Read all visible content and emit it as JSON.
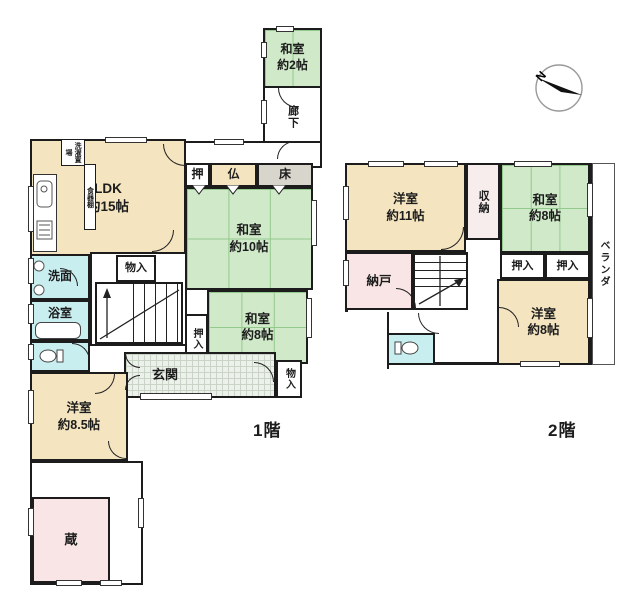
{
  "colors": {
    "wall": "#1c1c1c",
    "tatami": "#cfe9c9",
    "tatami_line": "#94c98e",
    "wood": "#f4e5c0",
    "wet": "#c9eef0",
    "pink": "#f9e5e5",
    "pale_pink": "#f7eded",
    "tokonoma": "#d7d5cc",
    "genkan": "#edf1eb",
    "genkan_line": "#c9d3c6"
  },
  "compass": {
    "label": "N"
  },
  "floors": {
    "f1": {
      "label": "1階",
      "rooms": {
        "washitsu2": {
          "name": "和室",
          "size": "約2帖"
        },
        "rouka": {
          "name": "廊下"
        },
        "ldk": {
          "name": "LDK",
          "size": "約15帖"
        },
        "sentaku": {
          "name": "洗濯置場"
        },
        "shokkidana": {
          "name": "食器棚"
        },
        "oshi": {
          "name": "押"
        },
        "butsu": {
          "name": "仏"
        },
        "toko": {
          "name": "床"
        },
        "washitsu10": {
          "name": "和室",
          "size": "約10帖"
        },
        "washitsu8": {
          "name": "和室",
          "size": "約8帖"
        },
        "oshiire": {
          "name": "押入"
        },
        "monoire_stair": {
          "name": "物入"
        },
        "senmen": {
          "name": "洗面"
        },
        "yokushitsu": {
          "name": "浴室"
        },
        "genkan": {
          "name": "玄関"
        },
        "monoire_genkan": {
          "name": "物入"
        },
        "yoshitsu85": {
          "name": "洋室",
          "size": "約8.5帖"
        },
        "kura": {
          "name": "蔵"
        }
      }
    },
    "f2": {
      "label": "2階",
      "rooms": {
        "yoshitsu11": {
          "name": "洋室",
          "size": "約11帖"
        },
        "shuno": {
          "name": "収納"
        },
        "washitsu8": {
          "name": "和室",
          "size": "約8帖"
        },
        "oshiire_a": {
          "name": "押入"
        },
        "oshiire_b": {
          "name": "押入"
        },
        "nando": {
          "name": "納戸"
        },
        "yoshitsu8": {
          "name": "洋室",
          "size": "約8帖"
        },
        "veranda": {
          "name": "ベランダ"
        }
      }
    }
  }
}
